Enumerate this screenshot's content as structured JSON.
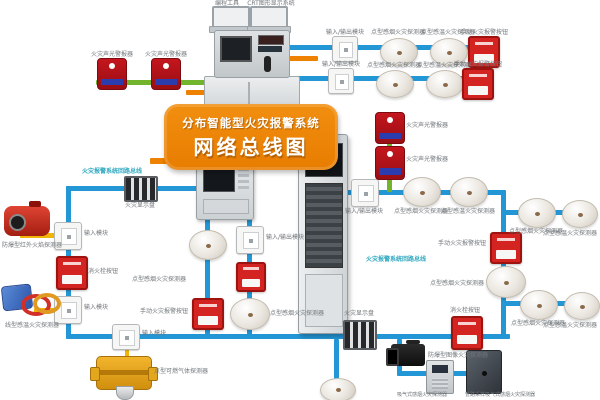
{
  "banner": {
    "line1": "分布智能型火灾报警系统",
    "line2": "网络总线图"
  },
  "colors": {
    "blue": "#2397d6",
    "green": "#72b52c",
    "yellow": "#f0b505",
    "orange": "#ee8200",
    "grey": "#9aa2a8",
    "cyan": "#2fa8c0",
    "label": "#70767a"
  },
  "edges": [
    {
      "x": 288,
      "y": 45,
      "w": 210,
      "h": 5,
      "c": "blue"
    },
    {
      "x": 284,
      "y": 76,
      "w": 200,
      "h": 5,
      "c": "blue"
    },
    {
      "x": 96,
      "y": 80,
      "w": 118,
      "h": 5,
      "c": "green"
    },
    {
      "x": 186,
      "y": 90,
      "w": 30,
      "h": 5,
      "c": "orange"
    },
    {
      "x": 288,
      "y": 56,
      "w": 30,
      "h": 5,
      "c": "orange"
    },
    {
      "x": 150,
      "y": 158,
      "w": 160,
      "h": 6,
      "c": "orange"
    },
    {
      "x": 66,
      "y": 186,
      "w": 134,
      "h": 5,
      "c": "blue"
    },
    {
      "x": 66,
      "y": 186,
      "w": 5,
      "h": 153,
      "c": "blue"
    },
    {
      "x": 66,
      "y": 334,
      "w": 444,
      "h": 5,
      "c": "blue"
    },
    {
      "x": 205,
      "y": 218,
      "w": 5,
      "h": 118,
      "c": "blue"
    },
    {
      "x": 247,
      "y": 218,
      "w": 5,
      "h": 118,
      "c": "blue"
    },
    {
      "x": 20,
      "y": 233,
      "w": 36,
      "h": 5,
      "c": "yellow"
    },
    {
      "x": 34,
      "y": 308,
      "w": 22,
      "h": 5,
      "c": "yellow"
    },
    {
      "x": 125,
      "y": 346,
      "w": 4,
      "h": 12,
      "c": "yellow"
    },
    {
      "x": 501,
      "y": 190,
      "w": 5,
      "h": 149,
      "c": "blue"
    },
    {
      "x": 346,
      "y": 190,
      "w": 158,
      "h": 5,
      "c": "blue"
    },
    {
      "x": 387,
      "y": 112,
      "w": 5,
      "h": 80,
      "c": "green"
    },
    {
      "x": 503,
      "y": 210,
      "w": 80,
      "h": 5,
      "c": "blue"
    },
    {
      "x": 503,
      "y": 301,
      "w": 80,
      "h": 5,
      "c": "blue"
    },
    {
      "x": 397,
      "y": 339,
      "w": 5,
      "h": 36,
      "c": "blue"
    },
    {
      "x": 397,
      "y": 371,
      "w": 88,
      "h": 5,
      "c": "blue"
    },
    {
      "x": 334,
      "y": 339,
      "w": 5,
      "h": 41,
      "c": "blue"
    },
    {
      "x": 228,
      "y": 25,
      "w": 2,
      "h": 9,
      "c": "grey"
    },
    {
      "x": 266,
      "y": 25,
      "w": 2,
      "h": 9,
      "c": "grey"
    }
  ],
  "nodes": [
    {
      "t": "laptop",
      "x": 212,
      "y": 6,
      "w": 34,
      "h": 20
    },
    {
      "t": "laptop",
      "x": 250,
      "y": 6,
      "w": 34,
      "h": 20
    },
    {
      "t": "console",
      "x": 204,
      "y": 30,
      "w": 96,
      "h": 92
    },
    {
      "t": "wallpanel",
      "x": 196,
      "y": 152,
      "w": 56,
      "h": 66
    },
    {
      "t": "floorpanel",
      "x": 298,
      "y": 134,
      "w": 48,
      "h": 198
    },
    {
      "t": "albox",
      "x": 97,
      "y": 58,
      "w": 28,
      "h": 30
    },
    {
      "t": "albox",
      "x": 151,
      "y": 58,
      "w": 28,
      "h": 30
    },
    {
      "t": "module",
      "x": 332,
      "y": 36,
      "w": 24,
      "h": 24
    },
    {
      "t": "smoke",
      "x": 380,
      "y": 38,
      "w": 36,
      "h": 26
    },
    {
      "t": "smoke",
      "x": 430,
      "y": 38,
      "w": 36,
      "h": 26
    },
    {
      "t": "callpoint",
      "x": 468,
      "y": 36,
      "w": 28,
      "h": 28
    },
    {
      "t": "module",
      "x": 328,
      "y": 68,
      "w": 24,
      "h": 24
    },
    {
      "t": "smoke",
      "x": 376,
      "y": 70,
      "w": 36,
      "h": 26
    },
    {
      "t": "smoke",
      "x": 426,
      "y": 70,
      "w": 36,
      "h": 26
    },
    {
      "t": "callpoint",
      "x": 462,
      "y": 68,
      "w": 28,
      "h": 28
    },
    {
      "t": "stripdev",
      "x": 124,
      "y": 176,
      "w": 30,
      "h": 22
    },
    {
      "t": "module",
      "x": 54,
      "y": 222,
      "w": 26,
      "h": 26
    },
    {
      "t": "flame",
      "x": 4,
      "y": 206,
      "w": 46,
      "h": 30
    },
    {
      "t": "callpoint",
      "x": 56,
      "y": 256,
      "w": 28,
      "h": 30
    },
    {
      "t": "module",
      "x": 54,
      "y": 296,
      "w": 26,
      "h": 26
    },
    {
      "t": "linearheat",
      "x": 2,
      "y": 284,
      "w": 50,
      "h": 32
    },
    {
      "t": "module",
      "x": 112,
      "y": 324,
      "w": 26,
      "h": 24
    },
    {
      "t": "gas",
      "x": 96,
      "y": 356,
      "w": 54,
      "h": 32
    },
    {
      "t": "smoke",
      "x": 189,
      "y": 230,
      "w": 36,
      "h": 28
    },
    {
      "t": "callpoint",
      "x": 192,
      "y": 298,
      "w": 28,
      "h": 28
    },
    {
      "t": "module",
      "x": 236,
      "y": 226,
      "w": 26,
      "h": 26
    },
    {
      "t": "callpoint",
      "x": 236,
      "y": 262,
      "w": 26,
      "h": 26
    },
    {
      "t": "smoke",
      "x": 230,
      "y": 298,
      "w": 38,
      "h": 30
    },
    {
      "t": "stripdev",
      "x": 343,
      "y": 320,
      "w": 30,
      "h": 26
    },
    {
      "t": "smoke",
      "x": 320,
      "y": 378,
      "w": 34,
      "h": 22
    },
    {
      "t": "callpoint",
      "x": 451,
      "y": 316,
      "w": 28,
      "h": 30
    },
    {
      "t": "module",
      "x": 351,
      "y": 179,
      "w": 26,
      "h": 26
    },
    {
      "t": "albox",
      "x": 375,
      "y": 112,
      "w": 28,
      "h": 30
    },
    {
      "t": "albox",
      "x": 375,
      "y": 146,
      "w": 28,
      "h": 32
    },
    {
      "t": "smoke",
      "x": 403,
      "y": 177,
      "w": 36,
      "h": 28
    },
    {
      "t": "smoke",
      "x": 450,
      "y": 177,
      "w": 36,
      "h": 28
    },
    {
      "t": "smoke",
      "x": 518,
      "y": 198,
      "w": 36,
      "h": 28
    },
    {
      "t": "smoke",
      "x": 562,
      "y": 200,
      "w": 34,
      "h": 26
    },
    {
      "t": "callpoint",
      "x": 490,
      "y": 232,
      "w": 28,
      "h": 28
    },
    {
      "t": "smoke",
      "x": 486,
      "y": 266,
      "w": 38,
      "h": 30
    },
    {
      "t": "smoke",
      "x": 520,
      "y": 290,
      "w": 36,
      "h": 28
    },
    {
      "t": "smoke",
      "x": 564,
      "y": 292,
      "w": 34,
      "h": 26
    },
    {
      "t": "camera",
      "x": 391,
      "y": 344,
      "w": 34,
      "h": 22
    },
    {
      "t": "aspbox",
      "x": 426,
      "y": 360,
      "w": 26,
      "h": 32
    },
    {
      "t": "darkbox",
      "x": 466,
      "y": 350,
      "w": 34,
      "h": 42
    }
  ],
  "labels": [
    {
      "t": "编程工具",
      "x": 204,
      "y": 0,
      "w": 46,
      "a": "center"
    },
    {
      "t": "CRT图形显示系统",
      "x": 242,
      "y": 0,
      "w": 58,
      "a": "center"
    },
    {
      "t": "火灾声光警报器",
      "x": 88,
      "y": 51,
      "w": 48,
      "a": "center"
    },
    {
      "t": "火灾声光警报器",
      "x": 142,
      "y": 51,
      "w": 48,
      "a": "center"
    },
    {
      "t": "输入/输出模块",
      "x": 318,
      "y": 29,
      "w": 54,
      "a": "center"
    },
    {
      "t": "点型感烟火灾探测器",
      "x": 362,
      "y": 29,
      "w": 72,
      "a": "center"
    },
    {
      "t": "点型感温火灾探测器",
      "x": 412,
      "y": 29,
      "w": 72,
      "a": "center"
    },
    {
      "t": "手动火灾报警按钮",
      "x": 456,
      "y": 29,
      "w": 56,
      "a": "center"
    },
    {
      "t": "输入/输出模块",
      "x": 314,
      "y": 61,
      "w": 54,
      "a": "center"
    },
    {
      "t": "点型感烟火灾探测器",
      "x": 358,
      "y": 62,
      "w": 72,
      "a": "center"
    },
    {
      "t": "点型感温火灾探测器",
      "x": 408,
      "y": 62,
      "w": 72,
      "a": "center"
    },
    {
      "t": "手动火灾报警按钮",
      "x": 450,
      "y": 61,
      "w": 56,
      "a": "center"
    },
    {
      "t": "火灾报警系统回路总线",
      "x": 82,
      "y": 168,
      "w": 84,
      "a": "left",
      "c": "cyan"
    },
    {
      "t": "火灾显示盘",
      "x": 118,
      "y": 202,
      "w": 44,
      "a": "center"
    },
    {
      "t": "输入模块",
      "x": 84,
      "y": 230,
      "w": 32,
      "a": "left"
    },
    {
      "t": "防爆型红外火焰探测器",
      "x": 0,
      "y": 242,
      "w": 64,
      "a": "center"
    },
    {
      "t": "消火栓按钮",
      "x": 88,
      "y": 268,
      "w": 40,
      "a": "left"
    },
    {
      "t": "输入模块",
      "x": 84,
      "y": 304,
      "w": 32,
      "a": "left"
    },
    {
      "t": "线型感温火灾探测器",
      "x": 0,
      "y": 322,
      "w": 64,
      "a": "center"
    },
    {
      "t": "输入模块",
      "x": 142,
      "y": 330,
      "w": 32,
      "a": "left"
    },
    {
      "t": "点型可燃气体探测器",
      "x": 154,
      "y": 368,
      "w": 60,
      "a": "left"
    },
    {
      "t": "点型感烟火灾探测器",
      "x": 126,
      "y": 276,
      "w": 60,
      "a": "right"
    },
    {
      "t": "手动火灾报警按钮",
      "x": 132,
      "y": 308,
      "w": 56,
      "a": "right"
    },
    {
      "t": "输入/输出模块",
      "x": 266,
      "y": 234,
      "w": 54,
      "a": "left"
    },
    {
      "t": "点型感烟火灾探测器",
      "x": 270,
      "y": 310,
      "w": 60,
      "a": "left"
    },
    {
      "t": "输入/输出模块",
      "x": 337,
      "y": 208,
      "w": 54,
      "a": "center"
    },
    {
      "t": "火灾声光警报器",
      "x": 406,
      "y": 122,
      "w": 48,
      "a": "left"
    },
    {
      "t": "火灾声光警报器",
      "x": 406,
      "y": 156,
      "w": 48,
      "a": "left"
    },
    {
      "t": "点型感烟火灾探测器",
      "x": 386,
      "y": 208,
      "w": 70,
      "a": "center"
    },
    {
      "t": "点型感温火灾探测器",
      "x": 433,
      "y": 208,
      "w": 70,
      "a": "center"
    },
    {
      "t": "点型感烟火灾探测器",
      "x": 501,
      "y": 228,
      "w": 70,
      "a": "center"
    },
    {
      "t": "点型感温火灾探测器",
      "x": 540,
      "y": 230,
      "w": 60,
      "a": "center"
    },
    {
      "t": "手动火灾报警按钮",
      "x": 428,
      "y": 240,
      "w": 58,
      "a": "right"
    },
    {
      "t": "点型感烟火灾探测器",
      "x": 424,
      "y": 280,
      "w": 60,
      "a": "right"
    },
    {
      "t": "火灾报警系统回路总线",
      "x": 366,
      "y": 256,
      "w": 84,
      "a": "left",
      "c": "cyan"
    },
    {
      "t": "点型感烟火灾探测器",
      "x": 503,
      "y": 320,
      "w": 70,
      "a": "center"
    },
    {
      "t": "点型感温火灾探测器",
      "x": 540,
      "y": 322,
      "w": 60,
      "a": "center"
    },
    {
      "t": "火灾显示盘",
      "x": 337,
      "y": 310,
      "w": 44,
      "a": "center"
    },
    {
      "t": "消火栓按钮",
      "x": 443,
      "y": 307,
      "w": 44,
      "a": "center"
    },
    {
      "t": "防爆型图像火灾探测器",
      "x": 428,
      "y": 352,
      "w": 72,
      "a": "left"
    },
    {
      "t": "吸气式感烟火灾探测器",
      "x": 392,
      "y": 392,
      "w": 60,
      "a": "center",
      "s": 5
    },
    {
      "t": "管路采样吸气式感烟火灾探测器",
      "x": 455,
      "y": 392,
      "w": 90,
      "a": "center",
      "s": 5
    }
  ]
}
